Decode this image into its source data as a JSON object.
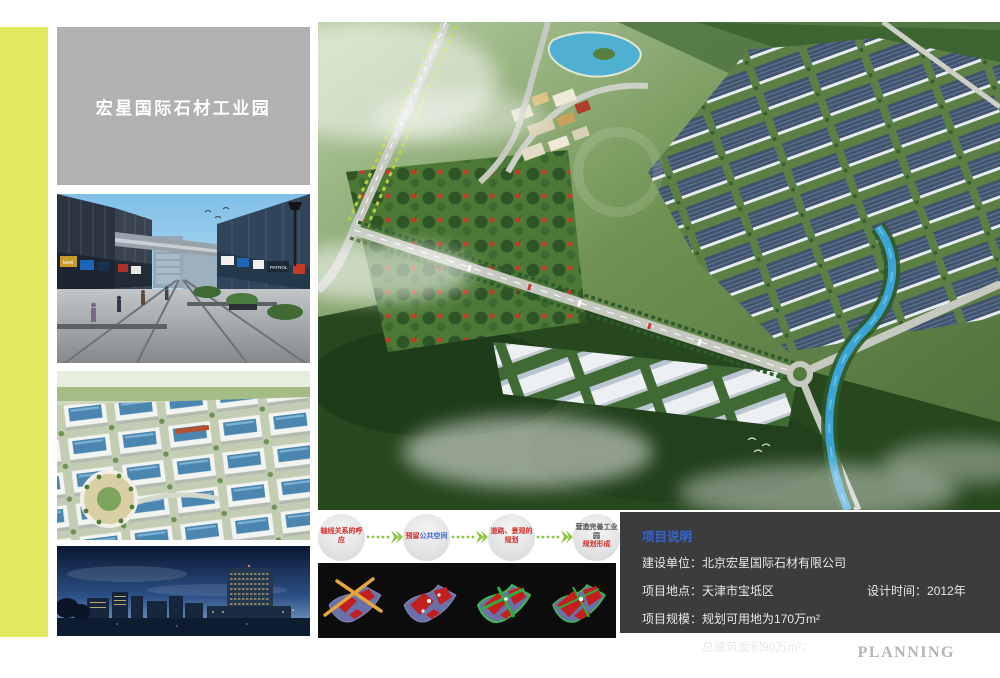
{
  "header": {
    "title": "宏星国际石材工业园"
  },
  "footer": {
    "brand": "PLANNING"
  },
  "colors": {
    "accent_stripe": "#e2e95f",
    "title_box_gray": "#b1b1b3",
    "project_box_gray": "#3c3c3e",
    "heading_blue": "#3565cd",
    "flow_text_red": "#d42b26",
    "arrow_green": "#8dc63f"
  },
  "flow": {
    "step1": {
      "text": "轴线关系的呼应"
    },
    "step2": {
      "prefix": "预留",
      "highlight": "公共空间"
    },
    "step3": {
      "text": "道路、景观的规划"
    },
    "step4": {
      "line1": "营造完善工业园",
      "line2": "规划形成"
    }
  },
  "project": {
    "heading": "项目说明",
    "rows": [
      {
        "label": "建设单位：",
        "value": "北京宏星国际石材有限公司"
      },
      {
        "label": "项目地点：",
        "value": "天津市宝坻区"
      },
      {
        "label": "项目规模：",
        "value": "规划可用地为170万m²"
      },
      {
        "label": "",
        "value": "总建筑面积90万m²；"
      }
    ],
    "design_time_label": "设计时间：",
    "design_time_value": "2012年"
  },
  "street_thumb": {
    "signs": [
      "lavei",
      "PATROL"
    ]
  }
}
